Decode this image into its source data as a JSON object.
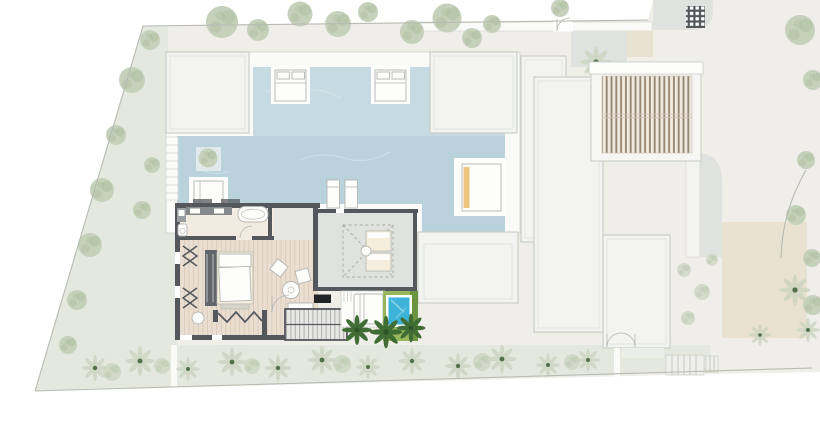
{
  "title": "Villa site plan — pools, suite floor plan and landscaped plot",
  "description": "Top-view architectural site plan: trapezoidal plot, L-shaped lap pool with in-water daybeds, detailed bedroom suite plan, plunge pool with palm trees, slatted pergola and white flat-roof volumes",
  "colors": {
    "page_bg": "#ffffff",
    "ground": "#efeee8",
    "lawn": "#e4e8df",
    "boundary": "#b7bbb2",
    "terrace": "#fafaf8",
    "roof_fill": "#f3f4f2",
    "roof_stroke": "#c6cac4",
    "roof_inner": "#dfe2dd",
    "pool_water": "#c6dae2",
    "pool_deep": "#a9c8d3",
    "plunge_water": "#3eb3da",
    "plunge_light": "#8fd6ea",
    "grass": "#98b65c",
    "hedge": "#6d9440",
    "palm": "#3f6d35",
    "palm_dark": "#2f5429",
    "palm_light": "#598a44",
    "tree": "#c6d1bb",
    "tree_speckle": "#a9bc9c",
    "shrub": "#ccd5c2",
    "wall": "#54575c",
    "wood_floor": "#e9ded1",
    "wood_line": "#d8c9b8",
    "bath_floor": "#f2ebe2",
    "pad_grey": "#e0e2df",
    "tan_pave": "#e9e2d0",
    "slat": "#93846f",
    "slat_bg": "#f0e9dd",
    "furniture_white": "#fdfdfc",
    "furniture_stroke": "#b5b6b0",
    "bed_cream": "#f6eedd",
    "towel_orange": "#ecc57e",
    "grill_black": "#212326",
    "steel": "#868a8d",
    "dash_line": "#a8aca6",
    "concrete": "#e6e7e4"
  },
  "features": {
    "plot": "trapezoidal site with perimeter planting",
    "main_pool": "L-shaped lap pool",
    "pool_daybeds": 2,
    "pool_loungers": 2,
    "pool_side_daybed_with_towel": 1,
    "suite": [
      "bathroom with tub and twin vanity",
      "dressing with louvre doors",
      "bedroom with bed and wardrobe",
      "lounge with two chairs and round table",
      "folding doors to terrace"
    ],
    "skylight_bedroom_beds": 2,
    "plunge_pool": "green-lawn surround plunge pool",
    "accent_palm_trees": 3,
    "pergola": "timber slatted roof",
    "roof_volumes": 5
  }
}
